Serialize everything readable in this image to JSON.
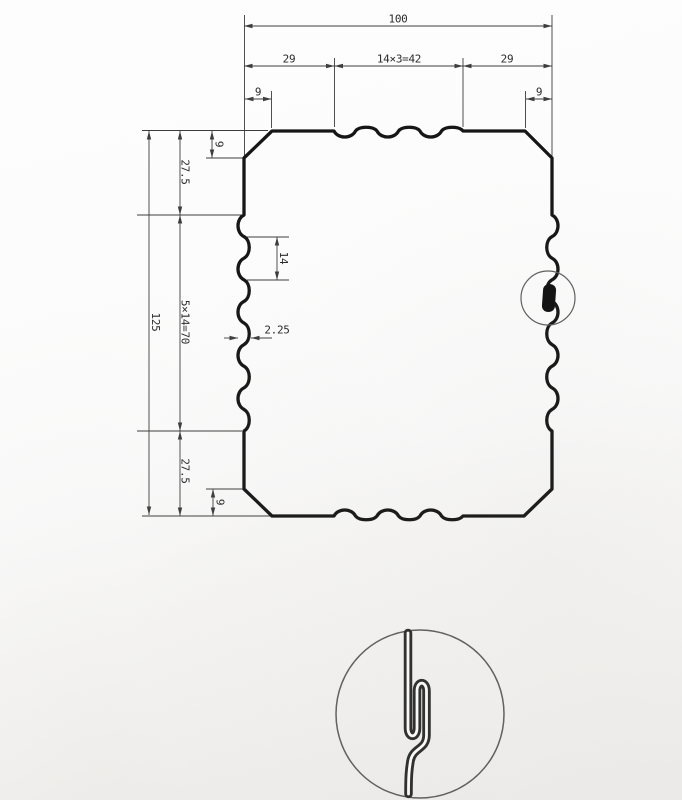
{
  "page": {
    "background": "#fcfcfc"
  },
  "drawing": {
    "type": "sheet-metal-panel-profile-cross-section",
    "dimensions": {
      "overall_width": "100",
      "top_left_segment": "29",
      "top_middle_segment": "14×3=42",
      "top_right_segment": "29",
      "top_left_chamfer": "9",
      "top_right_chamfer": "9",
      "overall_height": "125",
      "left_top_segment": "27.5",
      "left_middle_segment": "5×14=70",
      "left_bottom_segment": "27.5",
      "left_top_chamfer": "9",
      "left_bottom_chamfer": "9",
      "rib_pitch": "14",
      "rib_depth": "2.25"
    },
    "colors": {
      "outline": "#161616",
      "dimension": "#3d3d3d",
      "text": "#2b2b2b",
      "callout": "#5f5f5f",
      "seam_fill": "#111111",
      "seam_detail": "#2d2d2d"
    }
  }
}
